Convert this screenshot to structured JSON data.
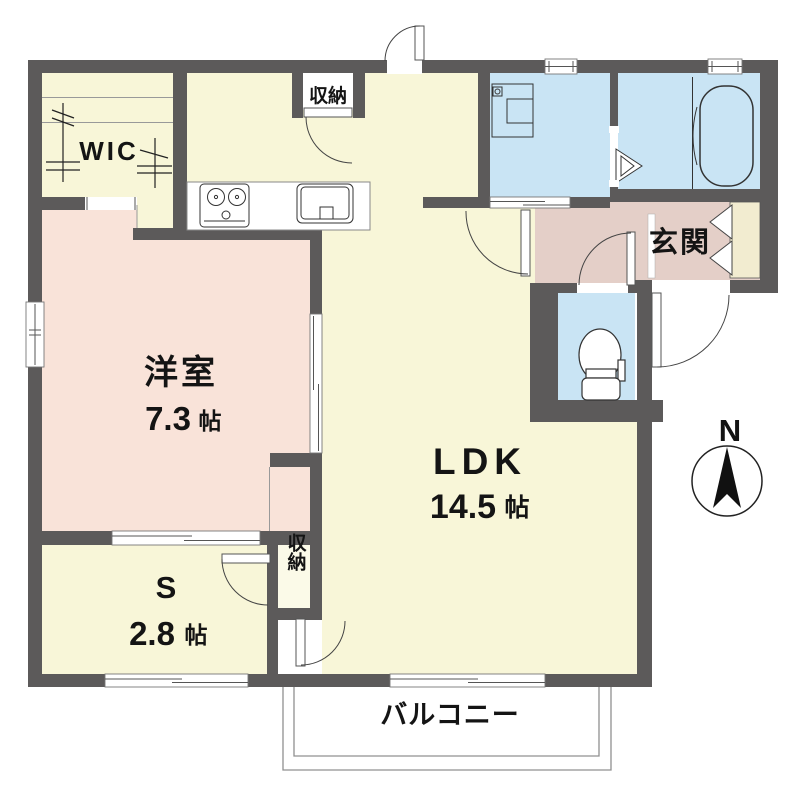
{
  "floorplan": {
    "rooms": {
      "wic": {
        "label": "WIC"
      },
      "storage_top": {
        "label": "収納"
      },
      "storage_bottom": {
        "label": "収納"
      },
      "western_room": {
        "label": "洋室",
        "size_value": "7.3",
        "size_unit": "帖"
      },
      "ldk": {
        "label": "LDK",
        "size_value": "14.5",
        "size_unit": "帖"
      },
      "service_room": {
        "label": "S",
        "size_value": "2.8",
        "size_unit": "帖"
      },
      "entrance": {
        "label": "玄関"
      },
      "balcony": {
        "label": "バルコニー"
      }
    },
    "compass": {
      "label": "N"
    },
    "colors": {
      "wall": "#5c5a5a",
      "floor-yellow": "#f8f6d8",
      "floor-pink": "#f9e3d9",
      "floor-hall": "#e4cfc8",
      "floor-blue": "#c9e4f4",
      "shoe-cabinet": "#f2ecd0"
    }
  }
}
